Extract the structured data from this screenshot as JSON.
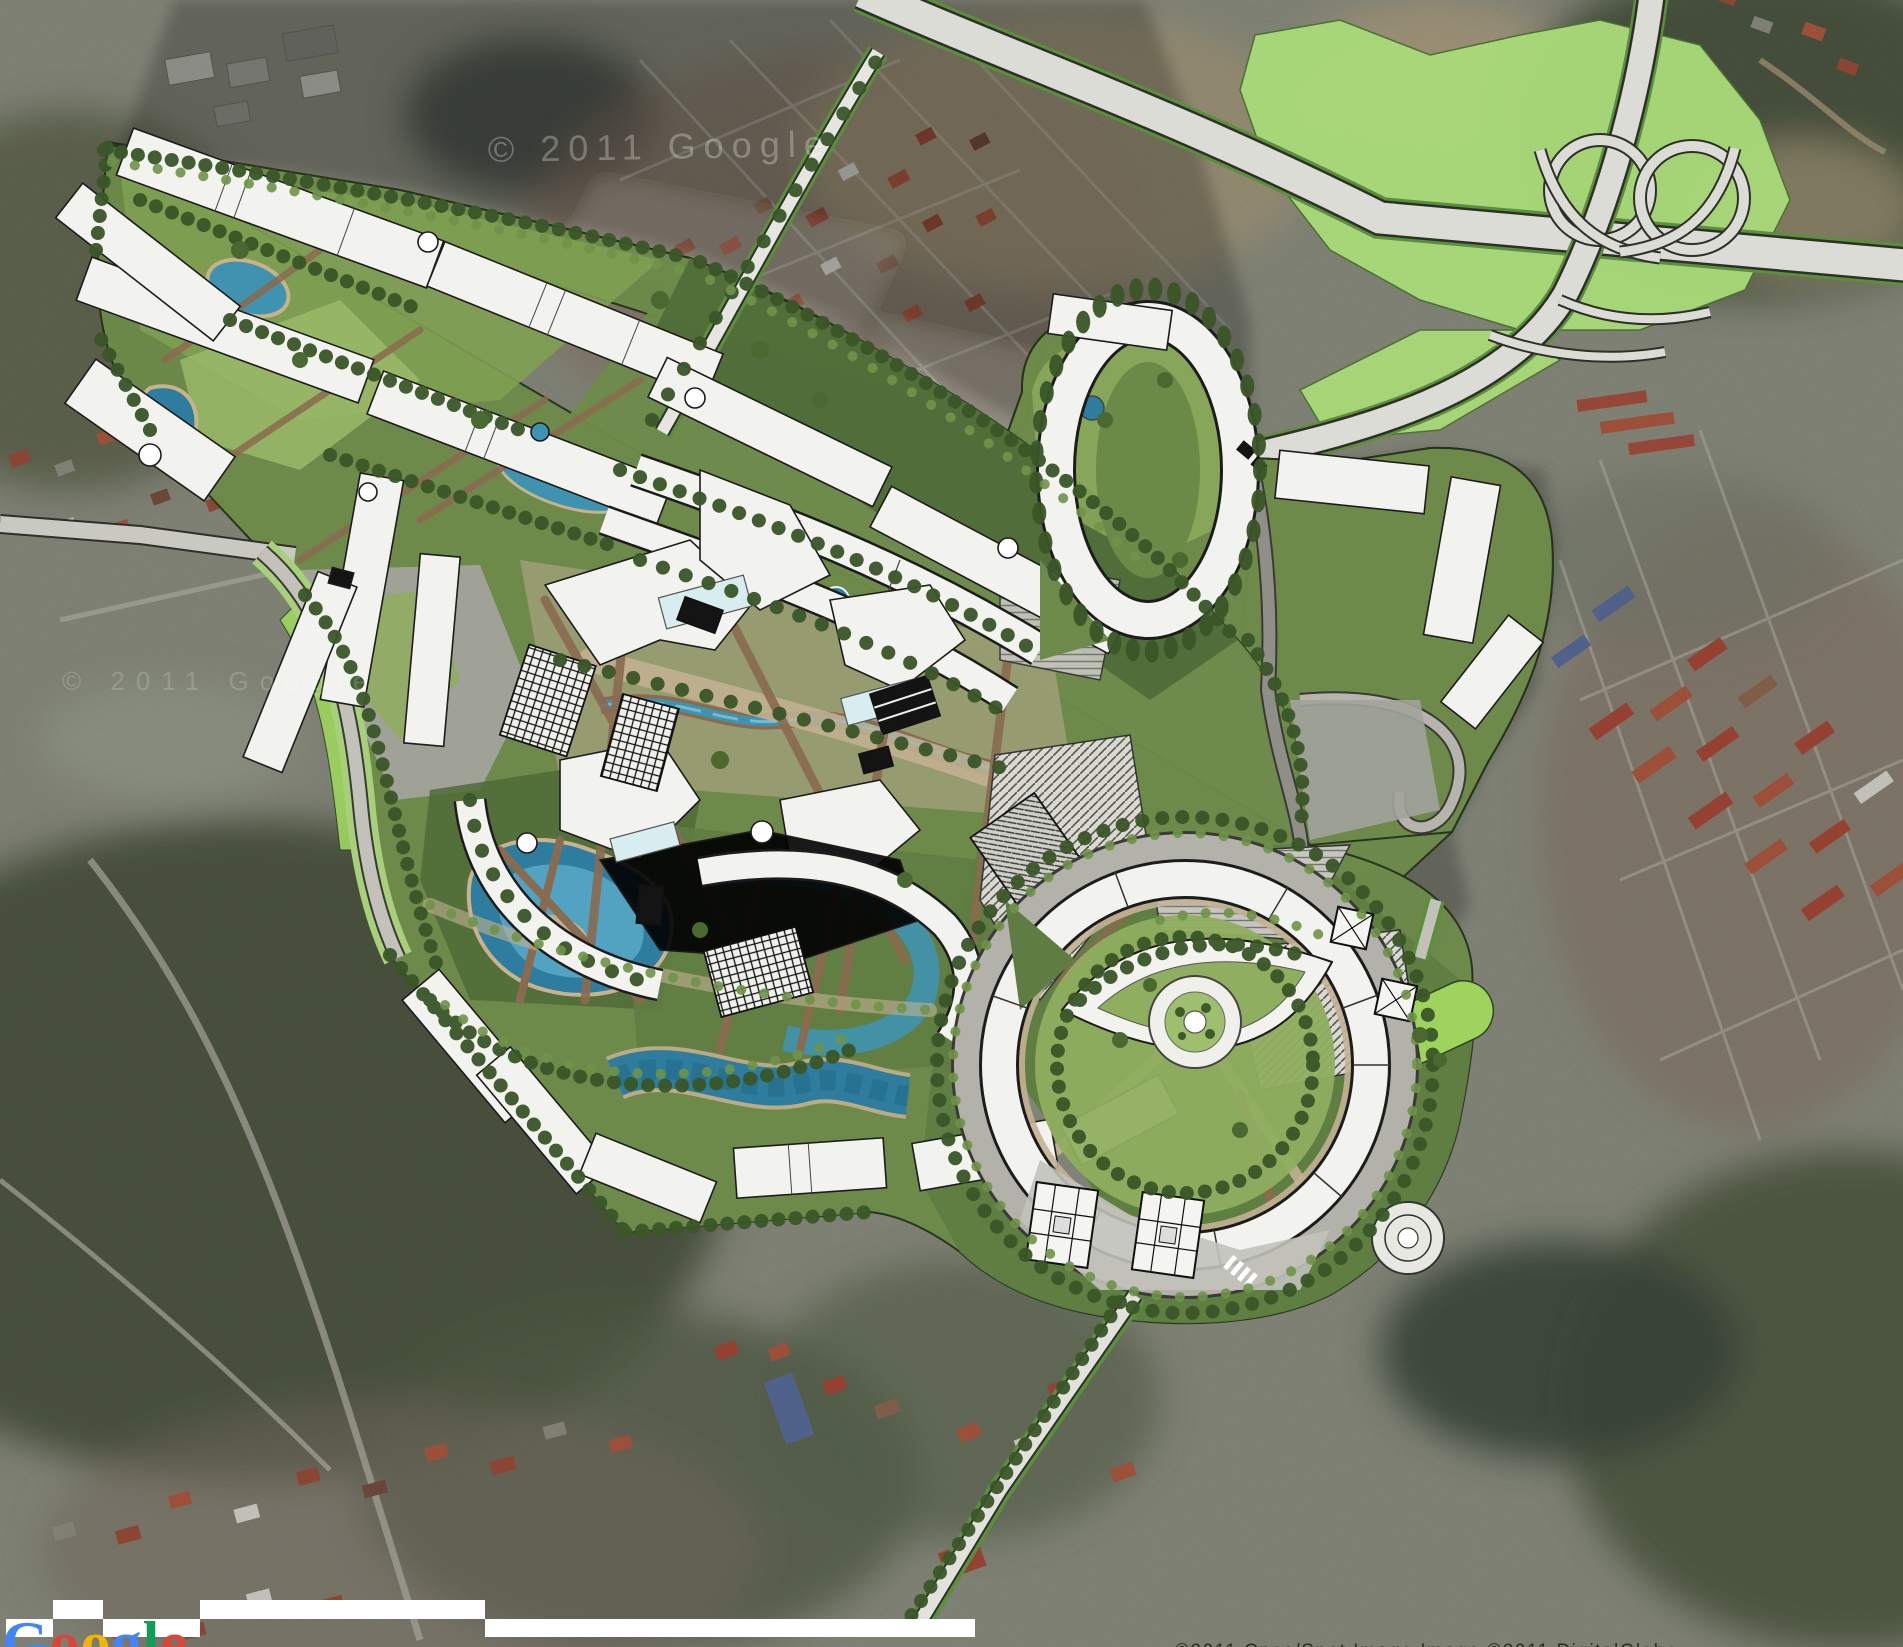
{
  "map": {
    "kind": "satellite-imagery-with-masterplan-overlay",
    "watermarks": {
      "center": "© 2011 Google",
      "left": "© 2011 Google"
    },
    "attribution": "©2011 Cnes/Spot Image  Image ©2011 DigitalGlobe",
    "logo": {
      "text": "Google",
      "letters": [
        {
          "char": "G",
          "color": "#4285F4"
        },
        {
          "char": "o",
          "color": "#DB4437"
        },
        {
          "char": "o",
          "color": "#F4B400"
        },
        {
          "char": "g",
          "color": "#4285F4"
        },
        {
          "char": "l",
          "color": "#0F9D58"
        },
        {
          "char": "e",
          "color": "#DB4437"
        }
      ]
    },
    "colors": {
      "building": "#f2f2ee",
      "building_outline": "#1c1c1c",
      "landscape_dark": "#4f6b38",
      "landscape": "#6d8a4a",
      "lawn": "#9cbb6a",
      "highway_green": "#a8d878",
      "water": "#2e7d9e",
      "water_light": "#7fc4d8",
      "glass": "#d7edef",
      "road": "#bcbcb4",
      "path_brown": "#8a6b4f",
      "path_tan": "#c3b193",
      "tower_black": "#141414",
      "shadow": "rgba(0,0,0,0.22)"
    },
    "features": {
      "interchange": "cloverleaf-interchange",
      "site": "masterplan-site",
      "eye_plaza": "circular-eye-plaza",
      "towers": "cross-plan-towers",
      "pools": "organic-pools"
    }
  }
}
